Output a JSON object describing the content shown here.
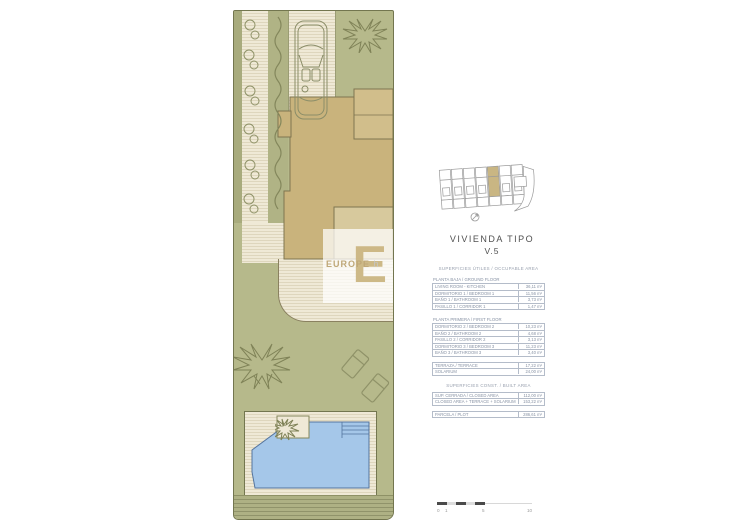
{
  "title": {
    "line1": "VIVIENDA TIPO",
    "line2": "V.5"
  },
  "watermark": {
    "logo_letter": "E",
    "brand": "EUROPE",
    "brand_suffix": "h"
  },
  "areas": {
    "useful_header": "SUPERFICIES ÚTILES / OCCUPABLE AREA",
    "ground_floor": {
      "title": "PLANTA BAJA / GROUND FLOOR",
      "rows": [
        {
          "label": "LIVING ROOM - KITCHEN",
          "value": "36,11 m²"
        },
        {
          "label": "DORMITORIO 1 / BEDROOM 1",
          "value": "11,56 m²"
        },
        {
          "label": "BAÑO 1 / BATHROOM 1",
          "value": "3,73 m²"
        },
        {
          "label": "PASILLO 1 / CORRIDOR 1",
          "value": "1,47 m²"
        }
      ]
    },
    "first_floor": {
      "title": "PLANTA PRIMERA / FIRST FLOOR",
      "rows": [
        {
          "label": "DORMITORIO 2 / BEDROOM 2",
          "value": "10,23 m²"
        },
        {
          "label": "BAÑO 2 / BATHROOM 2",
          "value": "4,68 m²"
        },
        {
          "label": "PASILLO 2 / CORRIDOR 2",
          "value": "3,13 m²"
        },
        {
          "label": "DORMITORIO 3 / BEDROOM 3",
          "value": "11,23 m²"
        },
        {
          "label": "BAÑO 3 / BATHROOM 3",
          "value": "3,40 m²"
        }
      ]
    },
    "exterior": {
      "rows": [
        {
          "label": "TERRAZA / TERRACE",
          "value": "17,22 m²"
        },
        {
          "label": "SOLARIUM",
          "value": "24,00 m²"
        }
      ]
    },
    "built_header": "SUPERFICIES CONST. / BUILT AREA",
    "built": {
      "rows": [
        {
          "label": "SUP. CERRADA / CLOSED AREA",
          "value": "112,00 m²"
        },
        {
          "label": "CLOSED AREA + TERRACE + SOLARIUM",
          "value": "153,22 m²"
        }
      ]
    },
    "plot": {
      "rows": [
        {
          "label": "PARCELA / PLOT",
          "value": "286,61 m²"
        }
      ]
    }
  },
  "scalebar": {
    "labels": [
      "0",
      "1",
      "5",
      "10"
    ]
  },
  "colors": {
    "lawn": "#b6b98b",
    "paving": "#efe9d6",
    "house": "#c9b37c",
    "house_light": "#d1be8b",
    "patio": "#d7c99d",
    "pool": "#a5c7e9",
    "highlight_unit": "#c9b683",
    "table_text": "#8792a4"
  },
  "icons": {
    "car": "car-icon",
    "tree": "tree-icon",
    "hedge": "hedge-icon",
    "bushes": "bushes-icon",
    "loungers": "lounger-icon",
    "plant": "planter-icon",
    "compass": "compass-icon"
  }
}
